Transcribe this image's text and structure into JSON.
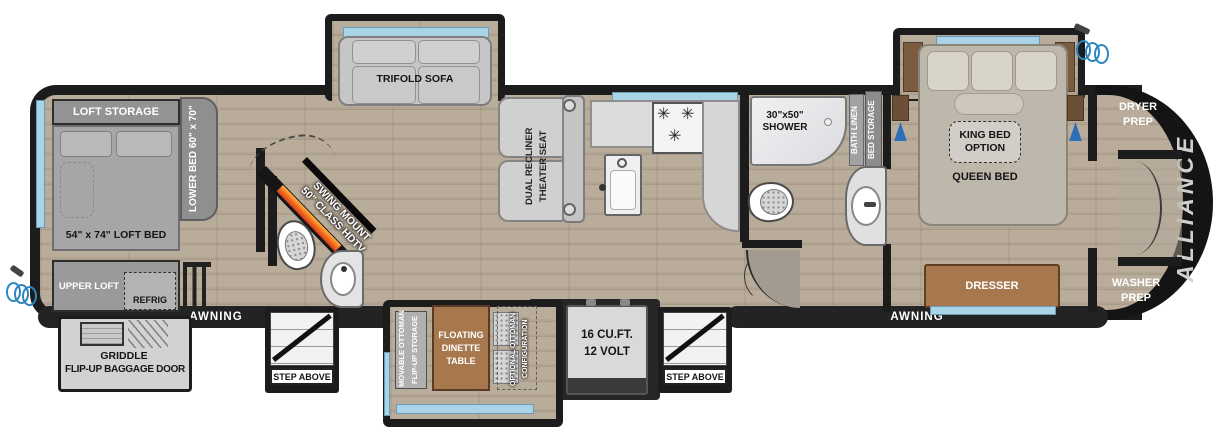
{
  "fp": {
    "brand": "ALLIANCE",
    "colors": {
      "wall": "#1c1c1c",
      "floor": "#b1a492",
      "window_accent": "#a9d3e6",
      "wood": "#a7784e",
      "fireplace_orange": "#ffb347",
      "fireplace_red": "#d63920",
      "hose_blue": "#2e86c1"
    },
    "exterior": {
      "awning_left": "AWNING",
      "awning_right": "AWNING",
      "step_left": "STEP ABOVE",
      "step_right": "STEP ABOVE",
      "griddle_line1": "GRIDDLE",
      "griddle_line2": "FLIP-UP BAGGAGE DOOR"
    },
    "rear_loft": {
      "loft_storage": "LOFT STORAGE",
      "lower_bed": "LOWER BED 60\" x 70\"",
      "loft_bed": "54\" x 74\" LOFT BED",
      "upper_loft": "UPPER LOFT",
      "refrig": "REFRIG"
    },
    "mid_bath": {
      "tv_line1": "SWING MOUNT",
      "tv_line2": "50\" CLASS HDTV"
    },
    "living": {
      "sofa": "TRIFOLD SOFA",
      "theater_line1": "DUAL RECLINER",
      "theater_line2": "THEATER SEAT",
      "ottoman_line1": "MOVABLE OTTOMAN",
      "ottoman_line2": "FLIP-UP STORAGE",
      "dinette_line1": "FLOATING",
      "dinette_line2": "DINETTE",
      "dinette_line3": "TABLE",
      "optional_line1": "OPTIONAL OTTOMAN",
      "optional_line2": "CONFIGURATION"
    },
    "kitchen": {
      "pantry_line1": "PULL-OUT",
      "pantry_line2": "PANTRY",
      "fridge_line1": "16 CU.FT.",
      "fridge_line2": "12 VOLT"
    },
    "bathroom": {
      "shower_line1": "30\"x50\"",
      "shower_line2": "SHOWER",
      "bath_linen": "BATH LINEN",
      "bed_storage": "BED STORAGE"
    },
    "bedroom": {
      "king_line1": "KING BED",
      "king_line2": "OPTION",
      "queen": "QUEEN BED",
      "dresser": "DRESSER"
    },
    "front": {
      "dryer_line1": "DRYER",
      "dryer_line2": "PREP",
      "washer_line1": "WASHER",
      "washer_line2": "PREP"
    }
  },
  "icons": {
    "burner": "✳"
  }
}
